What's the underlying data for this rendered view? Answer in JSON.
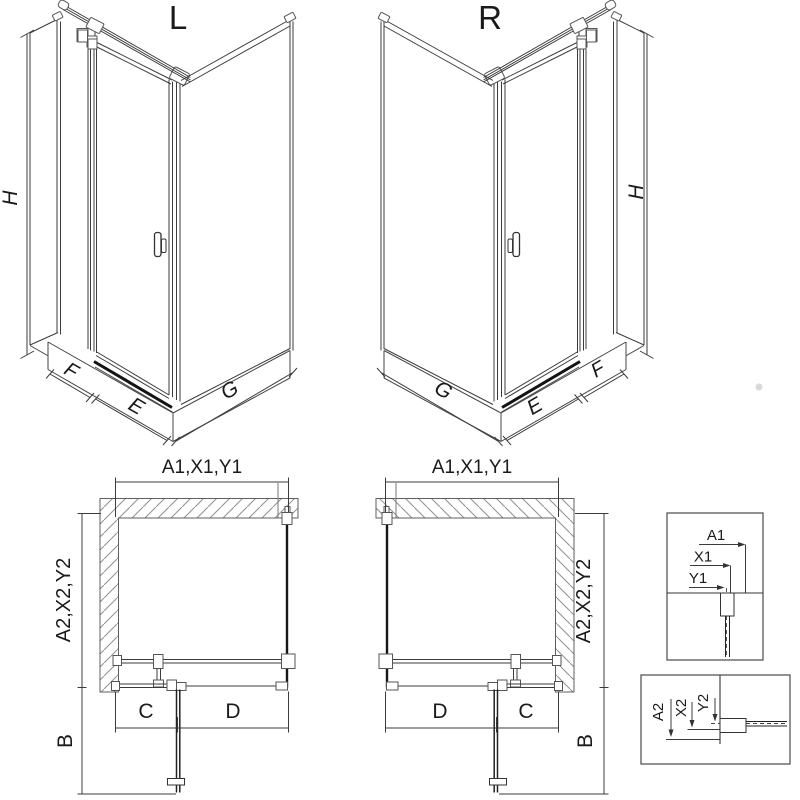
{
  "views": {
    "iso_left": {
      "label": "L",
      "dims": {
        "h": "H",
        "f": "F",
        "e": "E",
        "g": "G"
      }
    },
    "iso_right": {
      "label": "R",
      "dims": {
        "h": "H",
        "f": "F",
        "e": "E",
        "g": "G"
      }
    },
    "plan_left": {
      "dims": {
        "width_top": "A1,X1,Y1",
        "depth_side": "A2,X2,Y2",
        "c": "C",
        "d": "D",
        "b": "B"
      }
    },
    "plan_right": {
      "dims": {
        "width_top": "A1,X1,Y1",
        "depth_side": "A2,X2,Y2",
        "c": "C",
        "d": "D",
        "b": "B"
      }
    },
    "detail_top": {
      "a1": "A1",
      "x1": "X1",
      "y1": "Y1"
    },
    "detail_bottom": {
      "a2": "A2",
      "x2": "X2",
      "y2": "Y2"
    }
  },
  "colors": {
    "line": "#3b3b3b",
    "glass": "#161616",
    "hatch": "#909090",
    "text": "#1a1a1a",
    "background": "#ffffff"
  }
}
